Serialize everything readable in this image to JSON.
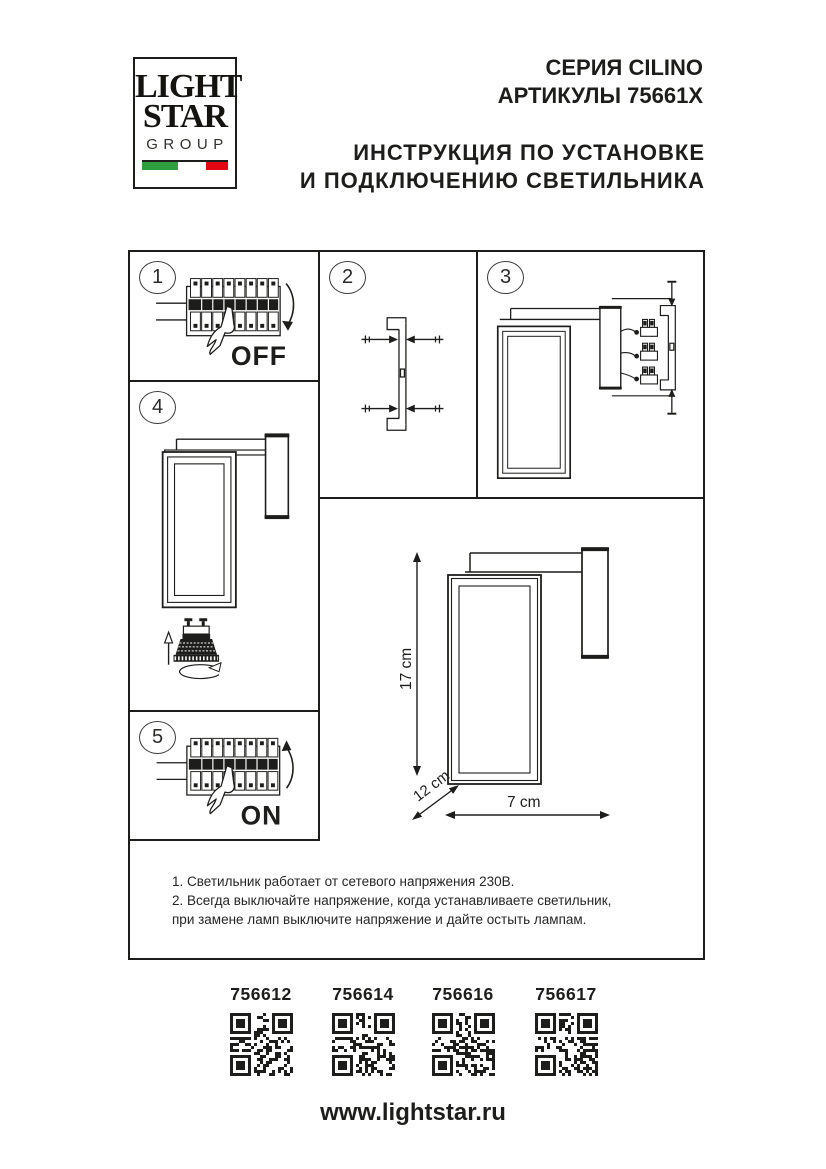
{
  "header": {
    "logo": {
      "line1": "LIGHT",
      "line2": "STAR",
      "line3": "GROUP"
    },
    "series": "СЕРИЯ CILINO",
    "articles": "АРТИКУЛЫ 75661X",
    "title_line1": "ИНСТРУКЦИЯ ПО УСТАНОВКЕ",
    "title_line2": "И ПОДКЛЮЧЕНИЮ СВЕТИЛЬНИКА"
  },
  "steps": {
    "s1": {
      "number": "1",
      "label": "OFF"
    },
    "s2": {
      "number": "2"
    },
    "s3": {
      "number": "3"
    },
    "s4": {
      "number": "4"
    },
    "s5": {
      "number": "5",
      "label": "ON"
    }
  },
  "dimensions": {
    "height": "17 cm",
    "depth": "12 cm",
    "width": "7 cm"
  },
  "notes": {
    "line1": "1. Светильник работает от сетевого напряжения 230В.",
    "line2": "2. Всегда выключайте напряжение, когда устанавливаете светильник,",
    "line3": "при замене ламп выключите напряжение и дайте остыть лампам."
  },
  "qr": {
    "items": [
      {
        "article": "756612"
      },
      {
        "article": "756614"
      },
      {
        "article": "756616"
      },
      {
        "article": "756617"
      }
    ]
  },
  "footer": {
    "website": "www.lightstar.ru"
  },
  "colors": {
    "ink": "#1d1d1b",
    "flag_green": "#2f9e3e",
    "flag_white": "#ffffff",
    "flag_red": "#e30613"
  }
}
